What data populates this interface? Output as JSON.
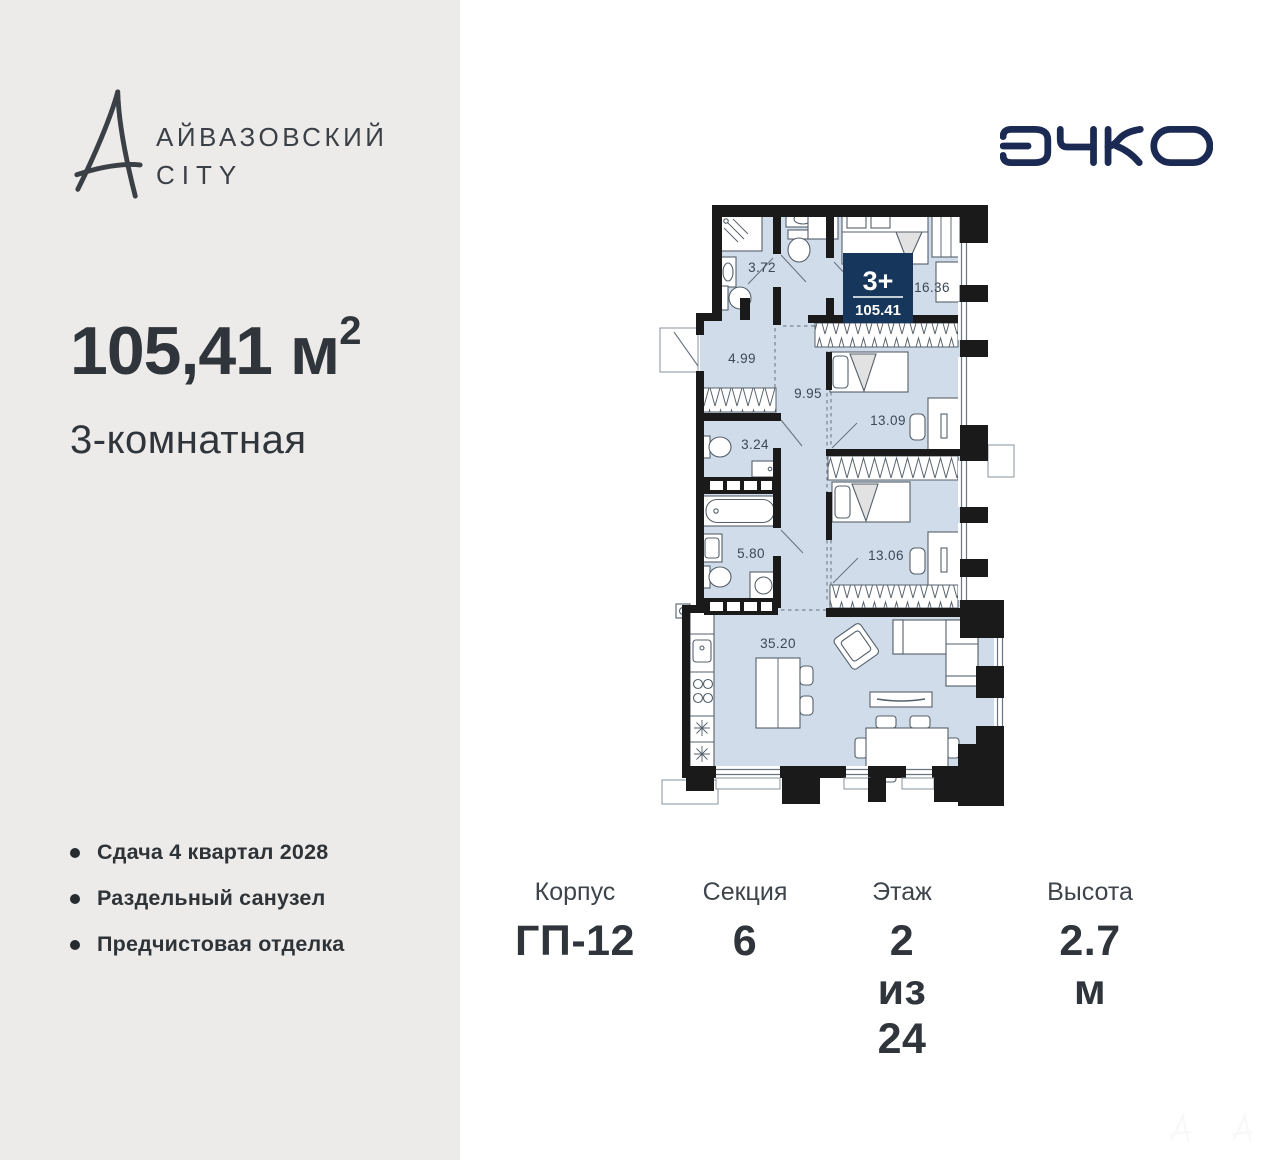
{
  "brand": {
    "line1": "АЙВАЗОВСКИЙ",
    "line2": "CITY"
  },
  "developer": {
    "name": "ЭНКО",
    "color": "#1B2A53"
  },
  "summary": {
    "area": "105,41 м",
    "area_superscript": "2",
    "type": "3-комнатная"
  },
  "features": [
    {
      "text": "Сдача 4 квартал 2028"
    },
    {
      "text": "Раздельный санузел"
    },
    {
      "text": "Предчистовая отделка"
    }
  ],
  "plan": {
    "badge": {
      "rooms": "3+",
      "area": "105.41",
      "color": "#17365B"
    },
    "fill_color": "#D0DCE9",
    "rooms": [
      {
        "name": "bathroom-shower",
        "area": "3.72"
      },
      {
        "name": "bedroom-master",
        "area": "16.36"
      },
      {
        "name": "hallway",
        "area": "4.99"
      },
      {
        "name": "corridor",
        "area": "9.95"
      },
      {
        "name": "wc",
        "area": "3.24"
      },
      {
        "name": "bedroom-2",
        "area": "13.09"
      },
      {
        "name": "bathroom-2",
        "area": "5.80"
      },
      {
        "name": "bedroom-3",
        "area": "13.06"
      },
      {
        "name": "kitchen-living",
        "area": "35.20"
      }
    ]
  },
  "specs": [
    {
      "label": "Корпус",
      "value": "ГП-12"
    },
    {
      "label": "Секция",
      "value": "6"
    },
    {
      "label": "Этаж",
      "value": "2 из 24"
    },
    {
      "label": "Высота",
      "value": "2.7 м"
    }
  ]
}
